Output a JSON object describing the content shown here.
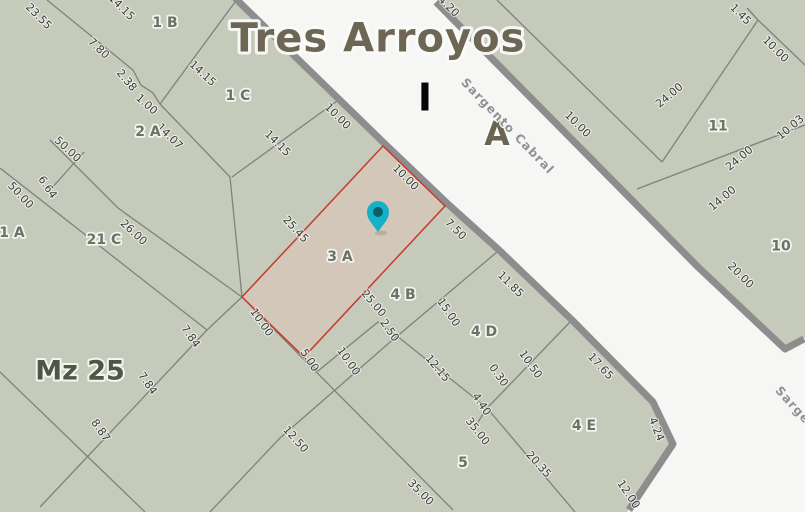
{
  "map": {
    "colors": {
      "parcel_fill": "#c6cabb",
      "street_fill": "#f6f6f5",
      "street_border": "#8d8d8d",
      "boundary_line": "#7e837b",
      "highlight_parcel_fill": "#d2c7b9",
      "highlight_parcel_border": "#c63a2e",
      "dimension_text": "#3b3e36",
      "parcel_name_text": "#6c7365",
      "block_name_text": "#4e5645",
      "title_text": "#6e6655",
      "block_letter_i_color": "#060606",
      "block_letter_a_color": "#6b6353",
      "street_name_text": "#8f9192",
      "pin_fill": "#17b1c7",
      "pin_hole": "#0b5f6b"
    },
    "geometry": {
      "left_block": "0,0 233,0 383,146 447,207 497,252 570,322 651,404 671,446 627,512 0,512",
      "right_block": "438,0 805,0 805,338 787,348 700,265",
      "street_border_left": "235,-2 385,144 449,205 499,250 572,320 653,402 673,444 629,510",
      "street_border_right": "436,2 698,267 785,349 804,339",
      "parcel_3a": "383,146 445,206 304,357 242,297",
      "lines": [
        "47,0 133,70 141,85 153,93 160,104",
        "160,104 235,2",
        "160,104 230,177 242,297",
        "232,177 337,101",
        "50,140 118,208 242,297",
        "84,152 50,190",
        "0,168 207,330",
        "207,330 40,507",
        "207,330 242,297",
        "0,372 145,512",
        "497,252 395,338",
        "304,357 318,371 378,322 397,336",
        "397,336 280,438 210,512",
        "242,297 453,510",
        "397,336 487,408",
        "487,408 494,401 570,322",
        "487,408 478,422",
        "487,408 575,512",
        "497,0 662,162",
        "637,189 805,125",
        "758,20 662,162",
        "758,20 805,65",
        "747,8 758,20"
      ]
    },
    "pin": {
      "cx": 378,
      "cy": 212,
      "tip_y": 232
    },
    "labels": {
      "title": {
        "t": "Tres Arroyos",
        "x": 378,
        "y": 37
      },
      "block_letter_i": {
        "t": "I",
        "x": 425,
        "y": 97
      },
      "block_letter_a": {
        "t": "A",
        "x": 497,
        "y": 133
      },
      "street_main": {
        "t": "Sargento Cabral",
        "x": 508,
        "y": 126,
        "r": 46
      },
      "street_secondary": {
        "t": "Sargento Cabral",
        "x": 778,
        "y": 388,
        "r": 48,
        "a": "start"
      },
      "manzana": {
        "t": "Mz 25",
        "x": 80,
        "y": 370
      },
      "parcels": [
        {
          "t": "1 B",
          "x": 165,
          "y": 22,
          "s": 14
        },
        {
          "t": "1 C",
          "x": 238,
          "y": 95,
          "s": 14
        },
        {
          "t": "2 A",
          "x": 148,
          "y": 131,
          "s": 14
        },
        {
          "t": "1 A",
          "x": 12,
          "y": 232,
          "s": 14
        },
        {
          "t": "21 C",
          "x": 104,
          "y": 239,
          "s": 14
        },
        {
          "t": "3 A",
          "x": 340,
          "y": 255,
          "s": 16
        },
        {
          "t": "4 B",
          "x": 403,
          "y": 294,
          "s": 14
        },
        {
          "t": "4 D",
          "x": 484,
          "y": 331,
          "s": 14
        },
        {
          "t": "4 E",
          "x": 584,
          "y": 425,
          "s": 14
        },
        {
          "t": "5",
          "x": 463,
          "y": 462,
          "s": 14
        },
        {
          "t": "11",
          "x": 718,
          "y": 125,
          "s": 15
        },
        {
          "t": "10",
          "x": 781,
          "y": 245,
          "s": 15
        }
      ],
      "dimensions": [
        {
          "t": "23.55",
          "x": 39,
          "y": 16,
          "r": 45
        },
        {
          "t": "7.80",
          "x": 99,
          "y": 48,
          "r": 44
        },
        {
          "t": "2.38",
          "x": 127,
          "y": 80,
          "r": 50
        },
        {
          "t": "1.00",
          "x": 147,
          "y": 104,
          "r": 42
        },
        {
          "t": "14.15",
          "x": 122,
          "y": 7,
          "r": 45
        },
        {
          "t": "14.15",
          "x": 203,
          "y": 73,
          "r": 43
        },
        {
          "t": "14.15",
          "x": 278,
          "y": 143,
          "r": 45
        },
        {
          "t": "14.07",
          "x": 170,
          "y": 136,
          "r": 45
        },
        {
          "t": "10.00",
          "x": 338,
          "y": 116,
          "r": 45
        },
        {
          "t": "50.00",
          "x": 68,
          "y": 149,
          "r": 43
        },
        {
          "t": "50.00",
          "x": 21,
          "y": 195,
          "r": 47
        },
        {
          "t": "6.64",
          "x": 48,
          "y": 187,
          "r": 56
        },
        {
          "t": "26.00",
          "x": 134,
          "y": 232,
          "r": 43
        },
        {
          "t": "7.84",
          "x": 191,
          "y": 336,
          "r": 55
        },
        {
          "t": "7.84",
          "x": 148,
          "y": 383,
          "r": 55
        },
        {
          "t": "8.87",
          "x": 101,
          "y": 430,
          "r": 55
        },
        {
          "t": "10.00",
          "x": 262,
          "y": 322,
          "r": 55
        },
        {
          "t": "5.00",
          "x": 310,
          "y": 360,
          "r": 57
        },
        {
          "t": "10.00",
          "x": 349,
          "y": 361,
          "r": 55
        },
        {
          "t": "2.50",
          "x": 390,
          "y": 330,
          "r": 55
        },
        {
          "t": "12.50",
          "x": 296,
          "y": 439,
          "r": 48
        },
        {
          "t": "35.00",
          "x": 421,
          "y": 492,
          "r": 45
        },
        {
          "t": "35.00",
          "x": 478,
          "y": 431,
          "r": 52
        },
        {
          "t": "12.15",
          "x": 438,
          "y": 368,
          "r": 50
        },
        {
          "t": "15.00",
          "x": 449,
          "y": 312,
          "r": 56
        },
        {
          "t": "0.30",
          "x": 499,
          "y": 375,
          "r": 55
        },
        {
          "t": "4.40",
          "x": 482,
          "y": 404,
          "r": 56
        },
        {
          "t": "10.50",
          "x": 531,
          "y": 364,
          "r": 55
        },
        {
          "t": "17.65",
          "x": 601,
          "y": 366,
          "r": 47
        },
        {
          "t": "11.85",
          "x": 511,
          "y": 284,
          "r": 45
        },
        {
          "t": "7.50",
          "x": 456,
          "y": 229,
          "r": 45
        },
        {
          "t": "25.45",
          "x": 296,
          "y": 229,
          "r": 47
        },
        {
          "t": "25.00",
          "x": 374,
          "y": 303,
          "r": 50
        },
        {
          "t": "10.00",
          "x": 406,
          "y": 177,
          "r": 45
        },
        {
          "t": "20.35",
          "x": 539,
          "y": 464,
          "r": 48
        },
        {
          "t": "12.00",
          "x": 629,
          "y": 494,
          "r": 56
        },
        {
          "t": "4.24",
          "x": 657,
          "y": 429,
          "r": 68
        },
        {
          "t": "1.45",
          "x": 741,
          "y": 14,
          "r": 45
        },
        {
          "t": "10.00",
          "x": 776,
          "y": 49,
          "r": 45
        },
        {
          "t": "24.00",
          "x": 669,
          "y": 95,
          "r": -40
        },
        {
          "t": "24.00",
          "x": 739,
          "y": 158,
          "r": -40
        },
        {
          "t": "14.00",
          "x": 722,
          "y": 198,
          "r": -40
        },
        {
          "t": "10.03",
          "x": 790,
          "y": 127,
          "r": -40
        },
        {
          "t": "20.00",
          "x": 741,
          "y": 275,
          "r": 45
        },
        {
          "t": "10.00",
          "x": 578,
          "y": 124,
          "r": 45
        },
        {
          "t": "4.20",
          "x": 449,
          "y": 6,
          "r": 45
        }
      ]
    }
  }
}
